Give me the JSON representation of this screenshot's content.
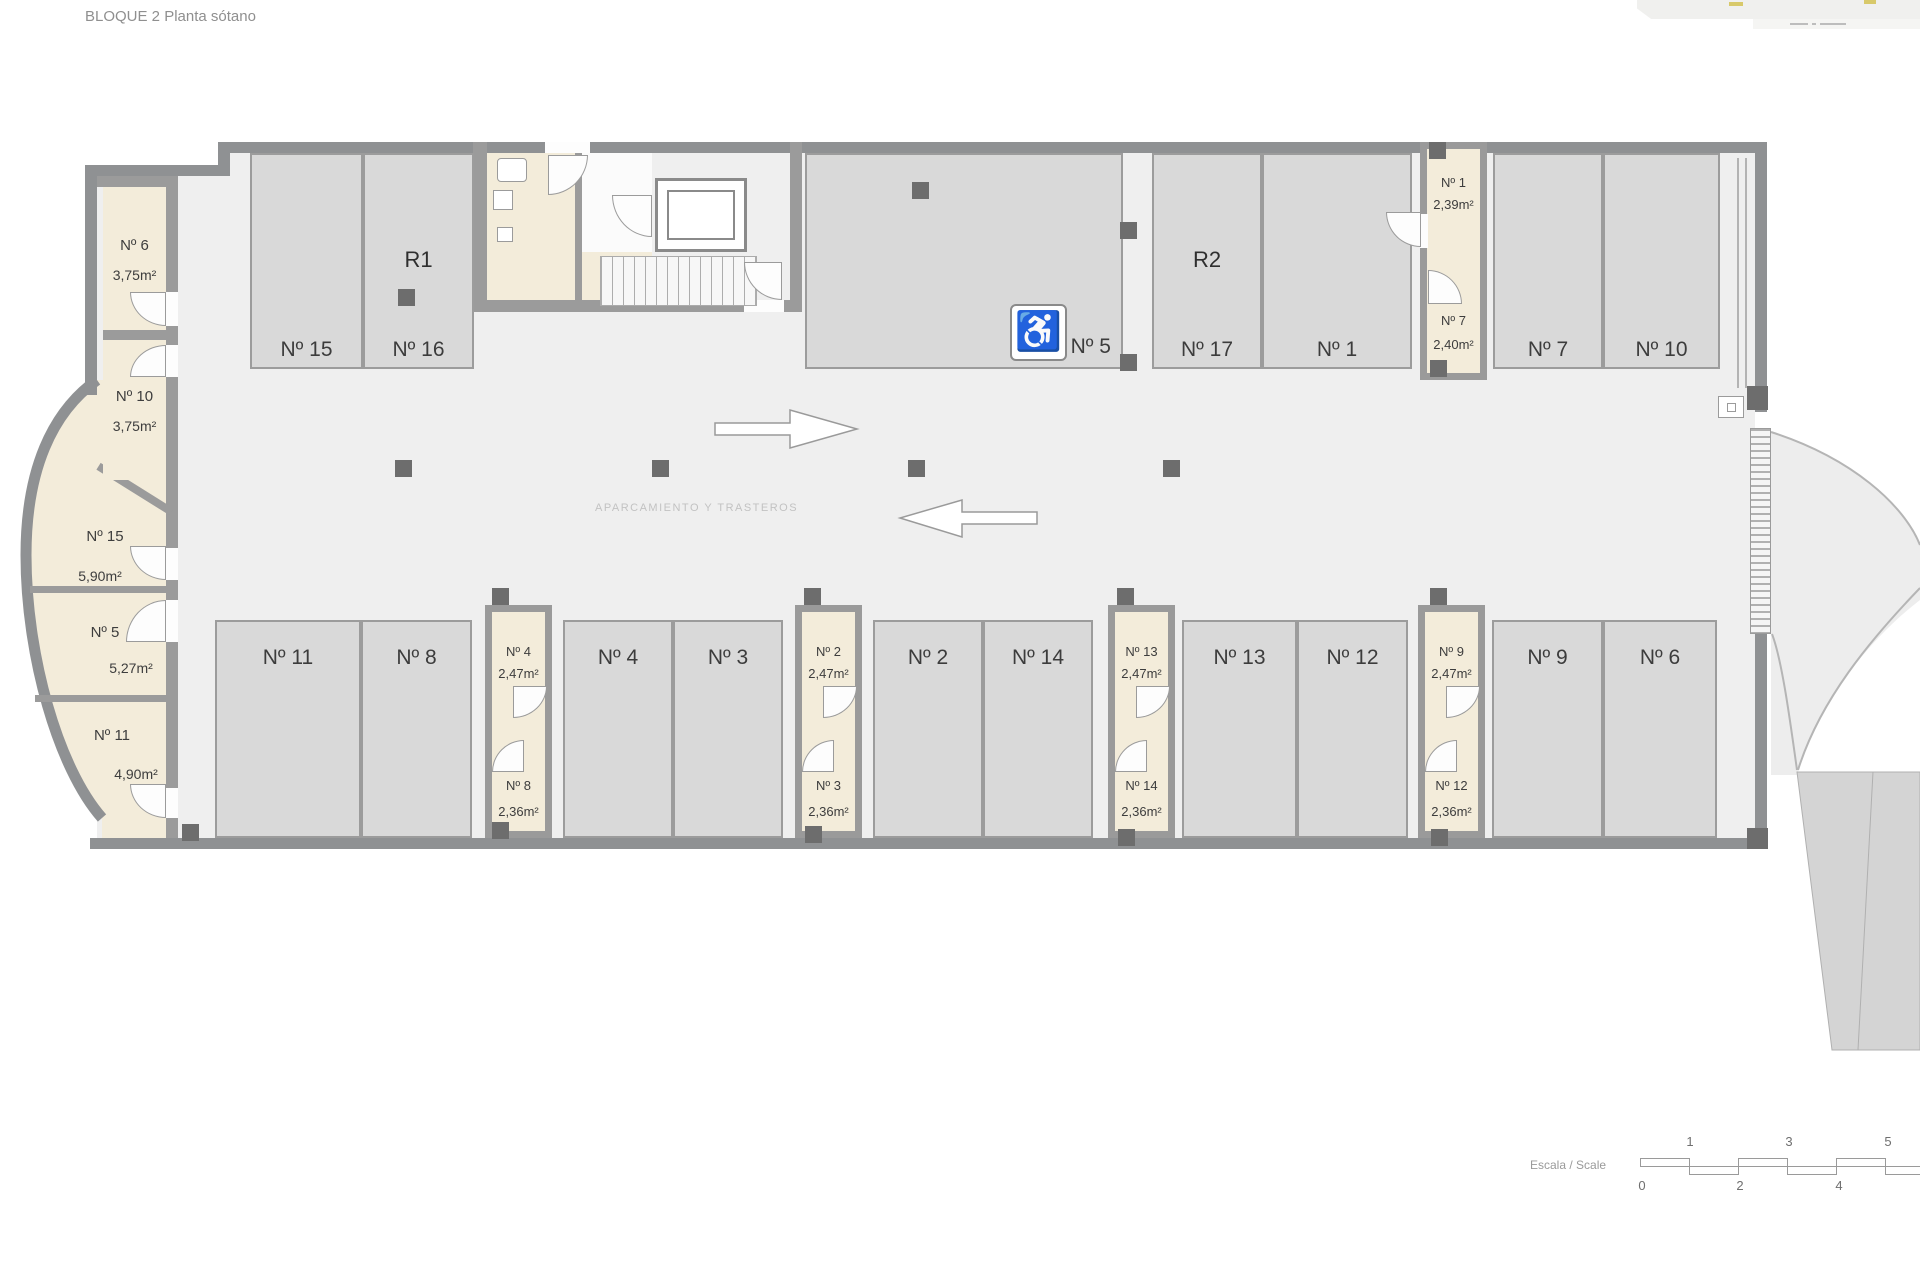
{
  "title": "BLOQUE 2 Planta sótano",
  "plan": {
    "center_label": "APARCAMIENTO Y TRASTEROS",
    "accessible_icon": "♿",
    "parking_top": [
      {
        "label": "Nº 15"
      },
      {
        "label": "Nº 16",
        "zone": "R1"
      },
      {
        "label": "Nº 5"
      },
      {
        "label": "Nº 17",
        "zone": "R2"
      },
      {
        "label": "Nº 1"
      },
      {
        "label": "Nº 7"
      },
      {
        "label": "Nº 10"
      }
    ],
    "parking_bottom": [
      {
        "label": "Nº 11"
      },
      {
        "label": "Nº 8"
      },
      {
        "label": "Nº 4"
      },
      {
        "label": "Nº 3"
      },
      {
        "label": "Nº 2"
      },
      {
        "label": "Nº 14"
      },
      {
        "label": "Nº 13"
      },
      {
        "label": "Nº 12"
      },
      {
        "label": "Nº 9"
      },
      {
        "label": "Nº 6"
      }
    ],
    "storage_left": [
      {
        "label": "Nº 6",
        "area": "3,75m²"
      },
      {
        "label": "Nº 10",
        "area": "3,75m²"
      },
      {
        "label": "Nº 15",
        "area": "5,90m²"
      },
      {
        "label": "Nº 5",
        "area": "5,27m²"
      },
      {
        "label": "Nº 11",
        "area": "4,90m²"
      }
    ],
    "storage_top_right": [
      {
        "label": "Nº 1",
        "area": "2,39m²"
      },
      {
        "label": "Nº 7",
        "area": "2,40m²"
      }
    ],
    "storage_bottom": [
      {
        "upper": {
          "label": "Nº 4",
          "area": "2,47m²"
        },
        "lower": {
          "label": "Nº 8",
          "area": "2,36m²"
        }
      },
      {
        "upper": {
          "label": "Nº 2",
          "area": "2,47m²"
        },
        "lower": {
          "label": "Nº 3",
          "area": "2,36m²"
        }
      },
      {
        "upper": {
          "label": "Nº 13",
          "area": "2,47m²"
        },
        "lower": {
          "label": "Nº 14",
          "area": "2,36m²"
        }
      },
      {
        "upper": {
          "label": "Nº 9",
          "area": "2,47m²"
        },
        "lower": {
          "label": "Nº 12",
          "area": "2,36m²"
        }
      }
    ]
  },
  "scale_bar": {
    "label": "Escala / Scale",
    "ticks_above": [
      "1",
      "3",
      "5"
    ],
    "ticks_below": [
      "0",
      "2",
      "4"
    ]
  },
  "colors": {
    "wall": "#8f9193",
    "parking_fill": "#d9d9d9",
    "storage_fill": "#f3ecda",
    "floor": "#efefef",
    "label": "#3c3c3c"
  }
}
